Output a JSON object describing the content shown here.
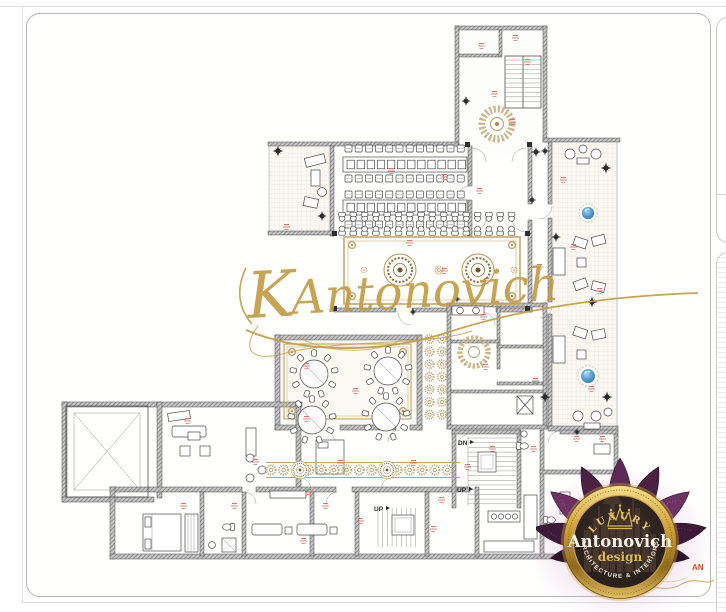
{
  "watermark": {
    "initial": "K",
    "name": "Antonovich"
  },
  "floor_plan": {
    "label_dn": "DN",
    "label_up_main": "UP",
    "label_up_service": "UP",
    "fragment_red": "AN"
  },
  "logo": {
    "top_text": "LUXURY",
    "brand": "Antonovich",
    "sub": "· design ·",
    "tagline": "ARCHITECTURE & INTERIORS"
  },
  "colors": {
    "watermark_gold": "#c49b45",
    "room_label_red": "#d4685f",
    "fountain_blue": "#2f7fc4",
    "carpet_gold": "#c3a36a",
    "logo_purple": "#4a2344",
    "logo_gold": "#d4a943"
  }
}
